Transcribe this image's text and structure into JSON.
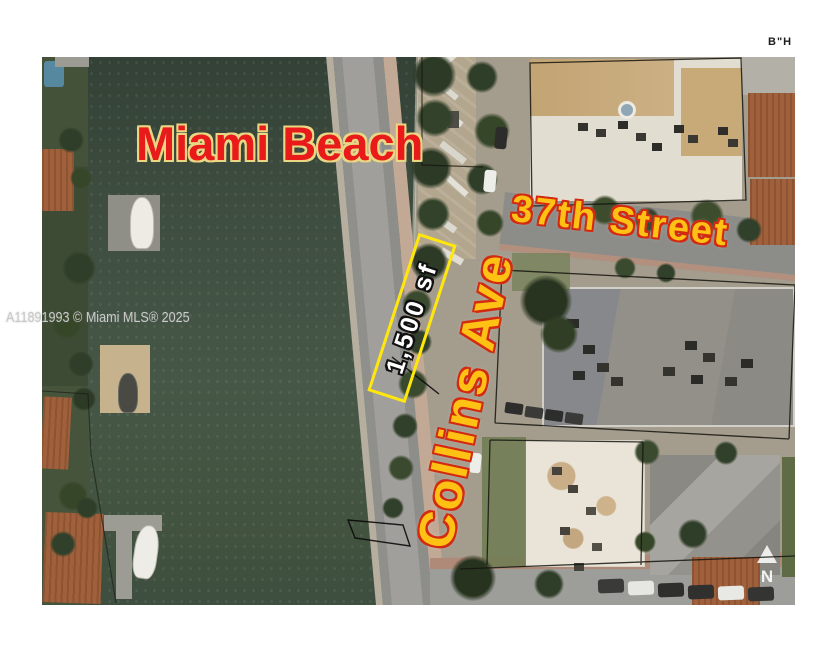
{
  "overlays": {
    "bh": "B\"H",
    "city": "Miami Beach",
    "street": "37th Street",
    "avenue": "Collins Ave",
    "parcel_area": "1,500 sf",
    "watermark": "A11891993 © Miami MLS® 2025",
    "north": "N"
  },
  "colors": {
    "city_fill": "#e81a1a",
    "city_outline": "#ead784",
    "street_fill": "#ffc113",
    "street_outline": "#d22b12",
    "parcel_box_border": "#ffe70d",
    "parcel_text": "#ffffff",
    "water": "#42533f",
    "background": "#ffffff"
  }
}
